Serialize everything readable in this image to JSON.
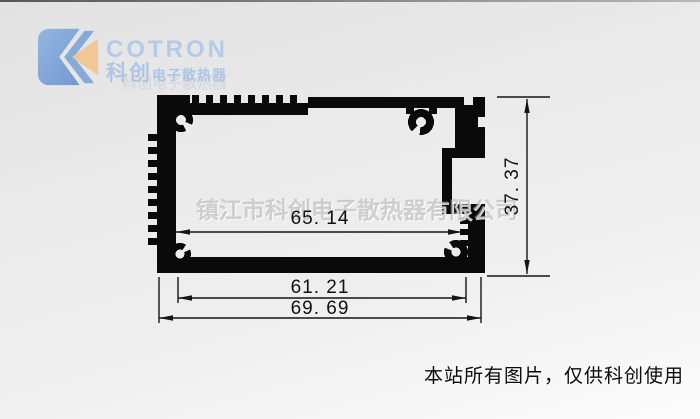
{
  "logo": {
    "brand": "COTRON",
    "brand_cn": "科创",
    "brand_cn_suffix": "电子散热器",
    "colors": {
      "blue_dark": "#4d7fc6",
      "blue_mid": "#6f9cd6",
      "blue_light": "#b4cbe8",
      "orange": "#f2c38e"
    }
  },
  "watermark": {
    "company": "镇江市科创电子散热器有限公司",
    "faint": "科创电子散热器"
  },
  "drawing": {
    "type": "aluminum-extrusion-profile-cross-section",
    "dims": {
      "inner_width": "65. 14",
      "bottom_inner_width": "61. 21",
      "overall_width": "69. 69",
      "overall_height": "37. 37"
    }
  },
  "footer": {
    "notice": "本站所有图片，仅供科创使用"
  }
}
